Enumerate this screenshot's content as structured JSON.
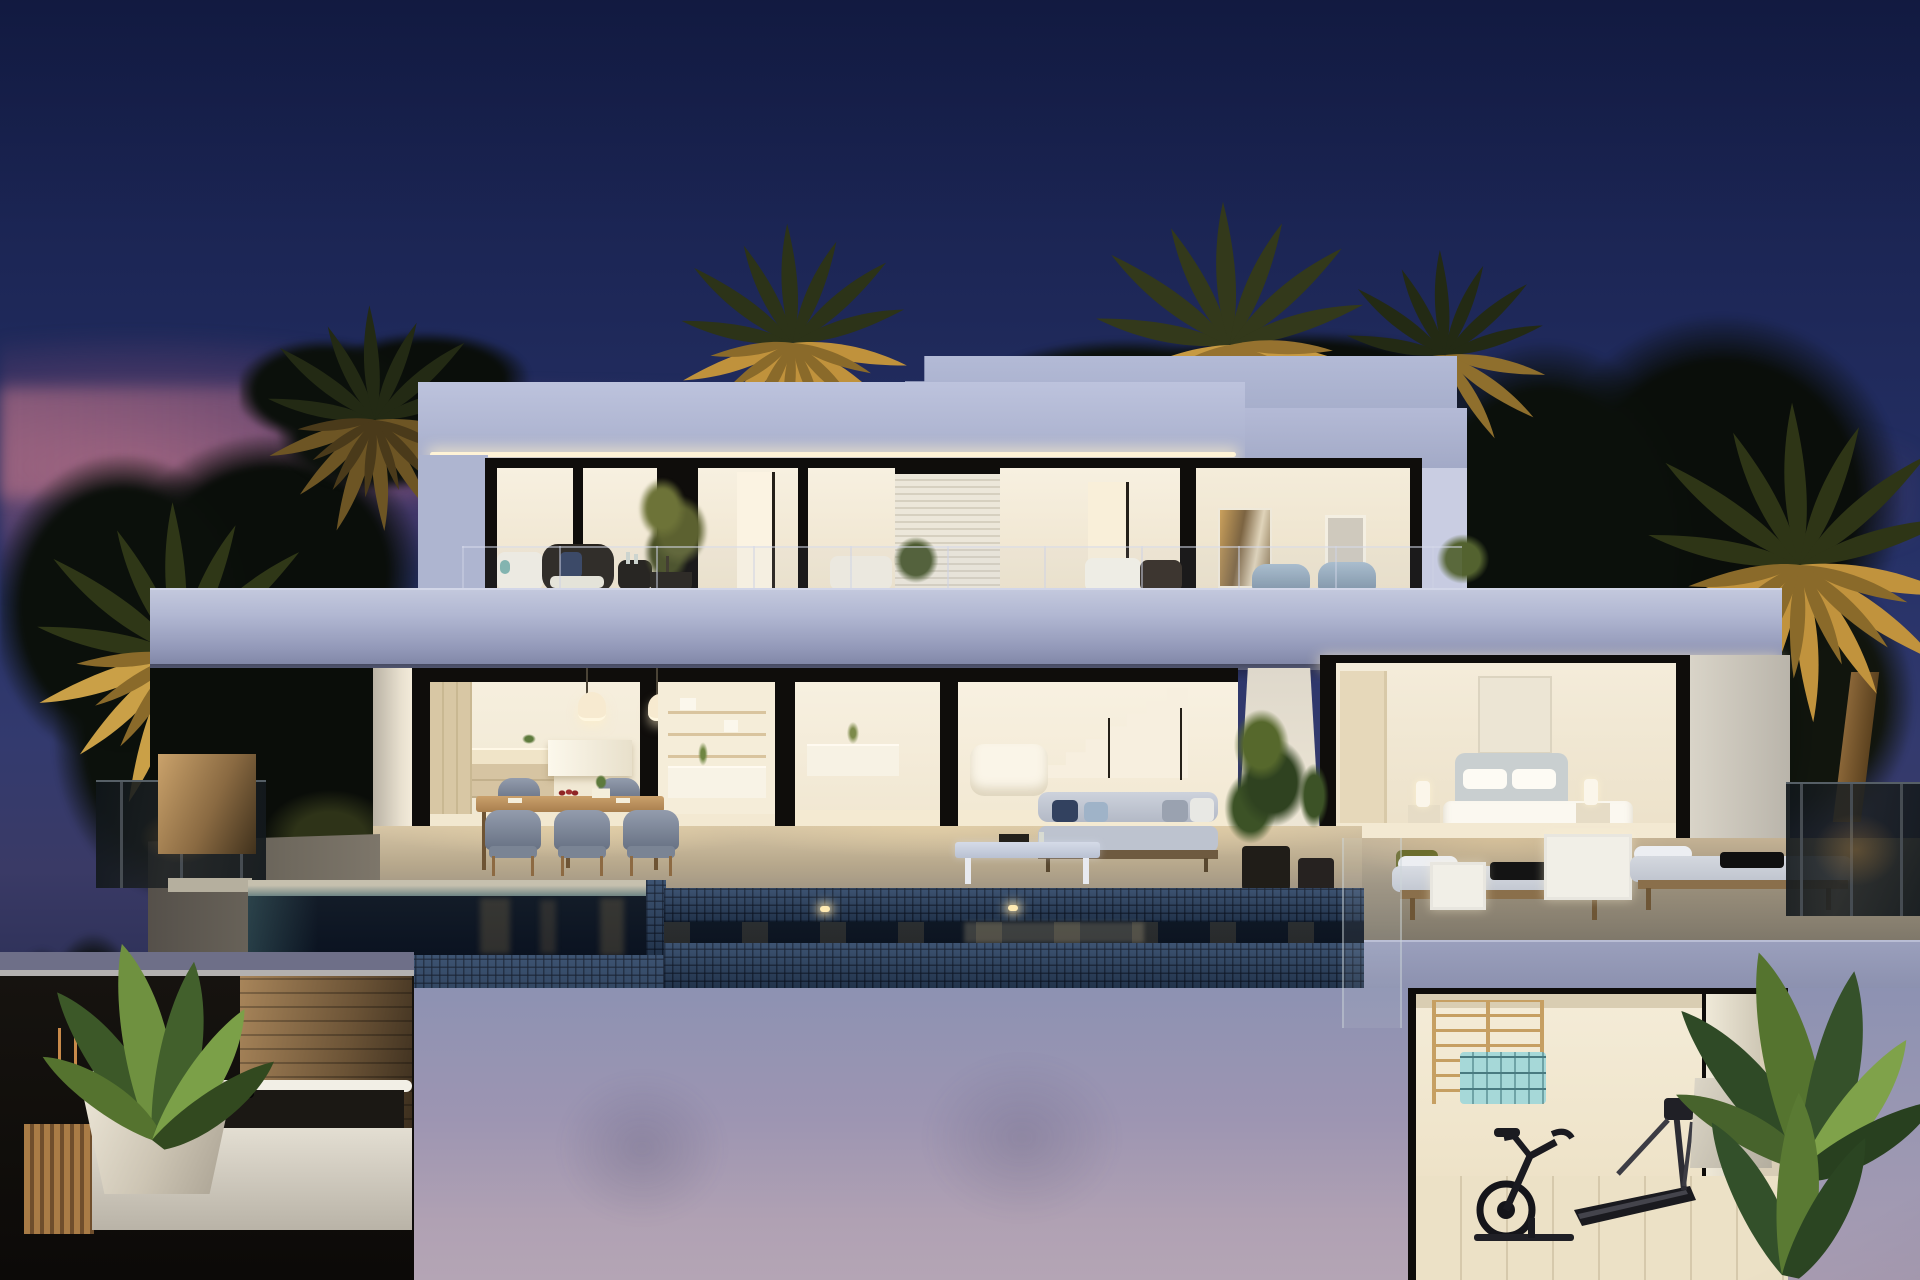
{
  "meta": {
    "domain": "Natural-Image",
    "description": "Twilight (dusk) 3D architectural rendering of a modern two-storey white villa with floor-to-ceiling glazing, warm interior lighting, a dark-tiled infinity pool, uplit palm trees, roof-terrace lounge furniture, outdoor dining set, sun loungers, and a lower level containing a spa tub and a home gym with exercise bike and treadmill.",
    "time_of_day": "dusk",
    "text_content": "none — image contains no visible text"
  },
  "colors": {
    "sky-top": "#131c46",
    "sky-mid": "#273268",
    "sunset-pink": "#c0748c",
    "facade": "#b7bdd8",
    "facade-shadow": "#9ba2c2",
    "slab-highlight": "#d2d6e8",
    "frame-dark": "#0f0d0b",
    "interior-warm": "#f6eedc",
    "interior-floor": "#f2e7cf",
    "led": "#fff3d6",
    "pool-tile": "#2d4566",
    "pool-water": "#0a1220",
    "terrace-warm": "#d6c5a5",
    "terrace-cool": "#877f6f",
    "lower-wall-top": "#8d92b2",
    "lower-wall-bottom": "#b4a5b5",
    "palm-gold": "#c79a42",
    "palm-gold-dim": "#8a6a2a",
    "frond-dark": "#2c3318",
    "leaf-green": "#3f5c2b",
    "leaf-green-light": "#72933f",
    "wood": "#b98e5c",
    "mat-teal": "#a6d8d8",
    "spa-stone": "#a07c50",
    "navy-pillow": "#32415f",
    "blue-cushion": "#a9bdcd"
  },
  "scene_objects": [
    "evening sky with sunset glow",
    "silhouetted trees and uplit palm trees",
    "roof-top stair tower volume",
    "upper floor with glazed wall, louvered panel, artwork and terrace furniture",
    "cantilevered balcony slab with glass railing",
    "ground floor glazing: kitchen with island and pendant lamps, shelving, living room with staircase and white sofa",
    "bedroom with upholstered bed, nightstands, lamps and wall art",
    "outdoor dining table with six woven chairs",
    "outdoor lounge sofa with cushions and coffee table",
    "two sun loungers with towels and white side tables",
    "potted plants and planters",
    "dark blue mosaic infinity pool with underwater lights",
    "lower level spa with white tub and banana plant",
    "lower level gym with wall bars, rolled mats, exercise bike and treadmill"
  ]
}
